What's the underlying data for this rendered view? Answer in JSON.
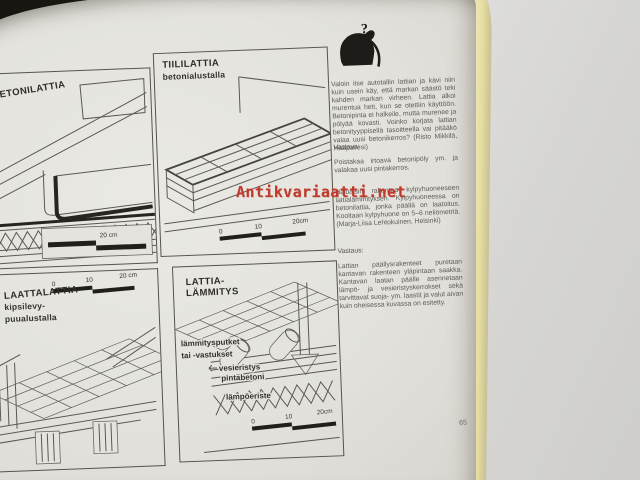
{
  "meta": {
    "page_number": "65"
  },
  "watermark": {
    "text": "Antikvariaatti.net",
    "color": "#c23a2c"
  },
  "panels": {
    "betonilattia": {
      "title": "BETONILATTIA",
      "scale_label": "20 cm"
    },
    "tiililattia": {
      "title": "TIILILATTIA",
      "subtitle": "betonialustalla",
      "scale": [
        "0",
        "10",
        "20cm"
      ]
    },
    "laattalattia": {
      "title": "LAATTALATTIA",
      "subtitle_line1": "kipsilevy-",
      "subtitle_line2": "puualustalla",
      "scale": [
        "0",
        "10",
        "20 cm"
      ]
    },
    "lattialammitys": {
      "title_line1": "LATTIA-",
      "title_line2": "LÄMMITYS",
      "labels": {
        "pipes_line1": "lämmitysputket",
        "pipes_line2": "tai -vastukset",
        "waterproofing": "vesieristys",
        "surface_concrete": "pintabetoni",
        "thermal_insulation": "lämpöeriste"
      },
      "scale": [
        "0",
        "10",
        "20cm"
      ]
    }
  },
  "qa": {
    "icon": "question-mark-figure-icon",
    "question_mark": "?",
    "question1": "Valoin itse autotallin lattian ja kävi niin kuin usein käy, että markan säästö teki kahden markan virheen. Lattia alkoi murentua heti, kun se otettiin käyttöön. Betonipinta ei halkeile, mutta murenee ja pölyää kovasti. Voinko korjata lattian betonityyppisellä tasoitteella vai pitääkö valaa uusi betonikerros? (Risto Mikkilä, Haapavesi)",
    "answer1_heading": "Vastaus:",
    "answer1": "Poistakaa irtoava betonipöly ym. ja valakaa uusi pintakerros.",
    "question2": "Haluaisin rakentaa kylpyhuoneeseen lattialämmityksen. Kylpyhuoneessa on betonilattia, jonka päällä on laatoitus. Kooltaan kylpyhuone on 5–6 neliömetriä. (Marja-Liisa Lehtokuinen, Helsinki)",
    "answer2_heading": "Vastaus:",
    "answer2": "Lattian päällysrakenteet puretaan kantavan rakenteen yläpintaan saakka. Kantavan laatan päälle asennetaan lämpö- ja vesieristyskerrokset sekä tarvittavat suoja- ym. laastit ja valut aivan kuin oheisessa kuvassa on esitetty."
  },
  "colors": {
    "paper": "#e4e3de",
    "line": "#57544d",
    "ink": "#2c2b27",
    "watermark_red": "#c23a2c",
    "page_edge_yellow": "#ece4ab",
    "right_surface": "#d6d5d2",
    "backdrop": "#181610"
  }
}
